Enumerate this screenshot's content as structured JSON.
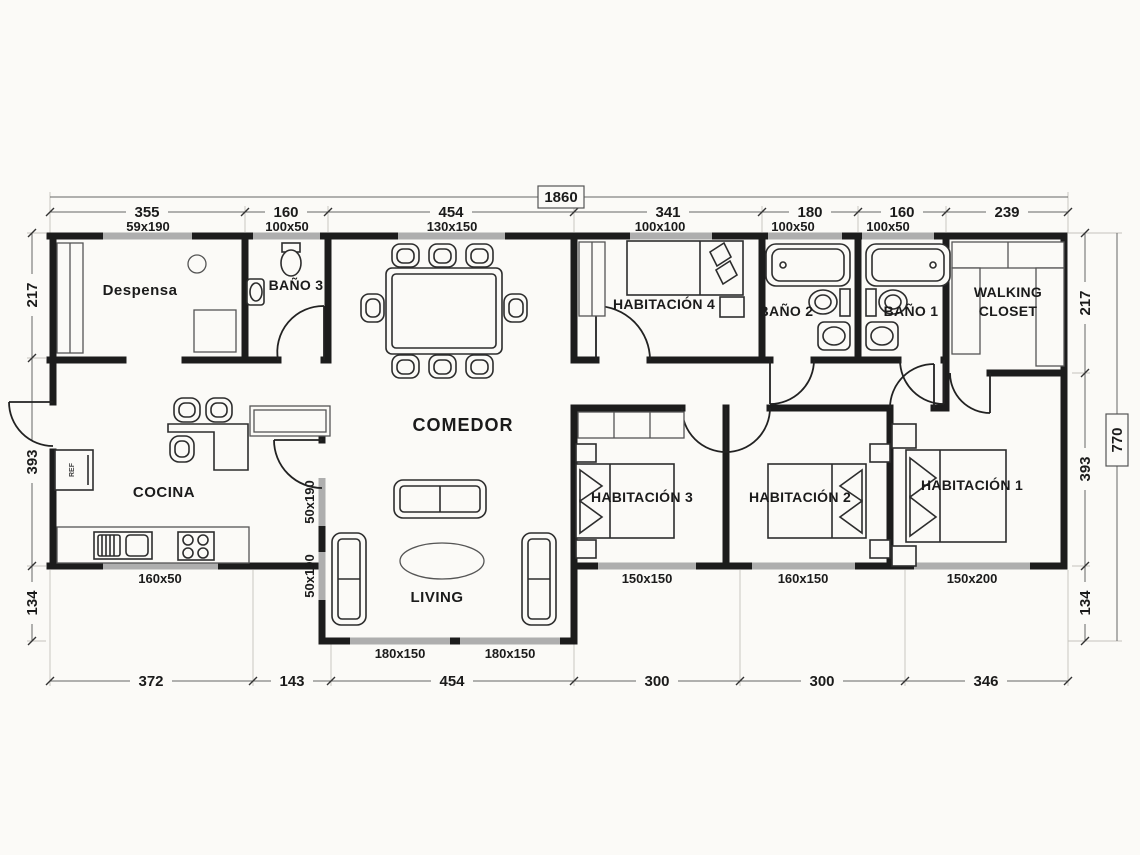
{
  "plan": {
    "total_width": "1860",
    "total_height": "770",
    "top_dims": [
      "355",
      "160",
      "454",
      "341",
      "180",
      "160",
      "239"
    ],
    "bottom_dims": [
      "372",
      "143",
      "454",
      "300",
      "300",
      "346"
    ],
    "left_dims": [
      "217",
      "393",
      "134"
    ],
    "right_dims": [
      "217",
      "393",
      "134"
    ],
    "rooms": {
      "despensa": "Despensa",
      "bano3": "BAÑO 3",
      "comedor": "COMEDOR",
      "habitacion4": "HABITACIÓN 4",
      "bano2": "BAÑO 2",
      "bano1": "BAÑO 1",
      "walking_closet_line1": "WALKING",
      "walking_closet_line2": "CLOSET",
      "cocina": "COCINA",
      "living": "LIVING",
      "habitacion3": "HABITACIÓN 3",
      "habitacion2": "HABITACIÓN 2",
      "habitacion1": "HABITACIÓN 1"
    },
    "windows": {
      "despensa": "59x190",
      "bano3": "100x50",
      "comedor": "130x150",
      "habitacion4": "100x100",
      "bano2": "100x50",
      "bano1": "100x50",
      "cocina": "160x50",
      "living_left_upper": "50x190",
      "living_left_lower": "50x190",
      "living_bottom_left": "180x150",
      "living_bottom_right": "180x150",
      "habitacion3": "150x150",
      "habitacion2": "160x150",
      "habitacion1": "150x200"
    },
    "appliances": {
      "fridge": "REF"
    }
  }
}
